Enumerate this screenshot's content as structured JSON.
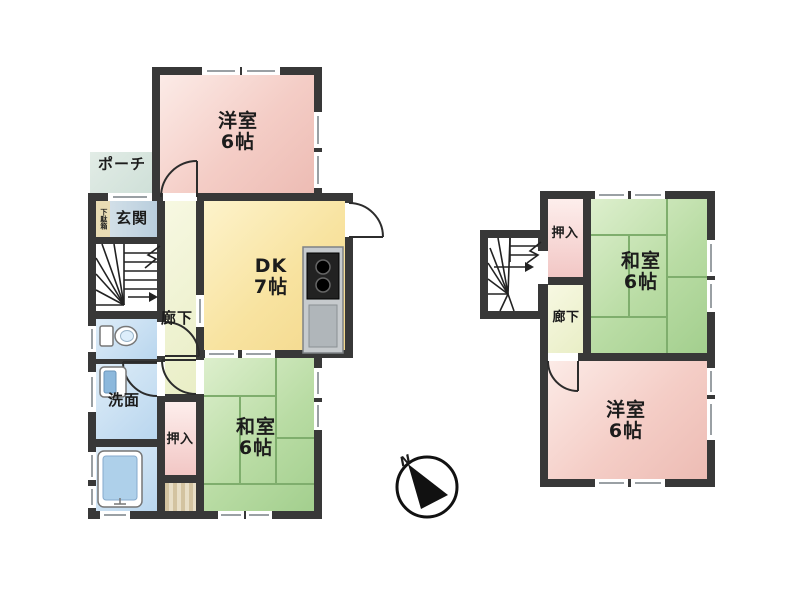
{
  "compass": {
    "label": "N"
  },
  "f1": {
    "west": {
      "name": "洋室",
      "size": "6帖"
    },
    "dk": {
      "name": "DK",
      "size": "7帖"
    },
    "washitsu": {
      "name": "和室",
      "size": "6帖"
    },
    "porch": {
      "name": "ポーチ"
    },
    "entrance": {
      "name": "玄関"
    },
    "shoe": {
      "name": "下駄箱"
    },
    "hall": {
      "name": "廊下"
    },
    "wash": {
      "name": "洗面"
    },
    "closet": {
      "name": "押入"
    }
  },
  "f2": {
    "closet": {
      "name": "押入"
    },
    "hall": {
      "name": "廊下"
    },
    "washitsu": {
      "name": "和室",
      "size": "6帖"
    },
    "west": {
      "name": "洋室",
      "size": "6帖"
    }
  },
  "palette": {
    "wall": "#383838",
    "western_room": "#f4cdc6",
    "dining_kitchen": "#f8e3a0",
    "tatami_room": "#b9dca4",
    "tatami_line": "#7fae6d",
    "water_rooms": "#b9d6ee",
    "closet": "#f2c7c5",
    "corridor": "#e9eec6",
    "porch": "#cfe0d8",
    "entrance": "#b9cedd",
    "shoe_cabinet": "#e9dcb4",
    "floor_stripes": "#d3c3a0"
  }
}
